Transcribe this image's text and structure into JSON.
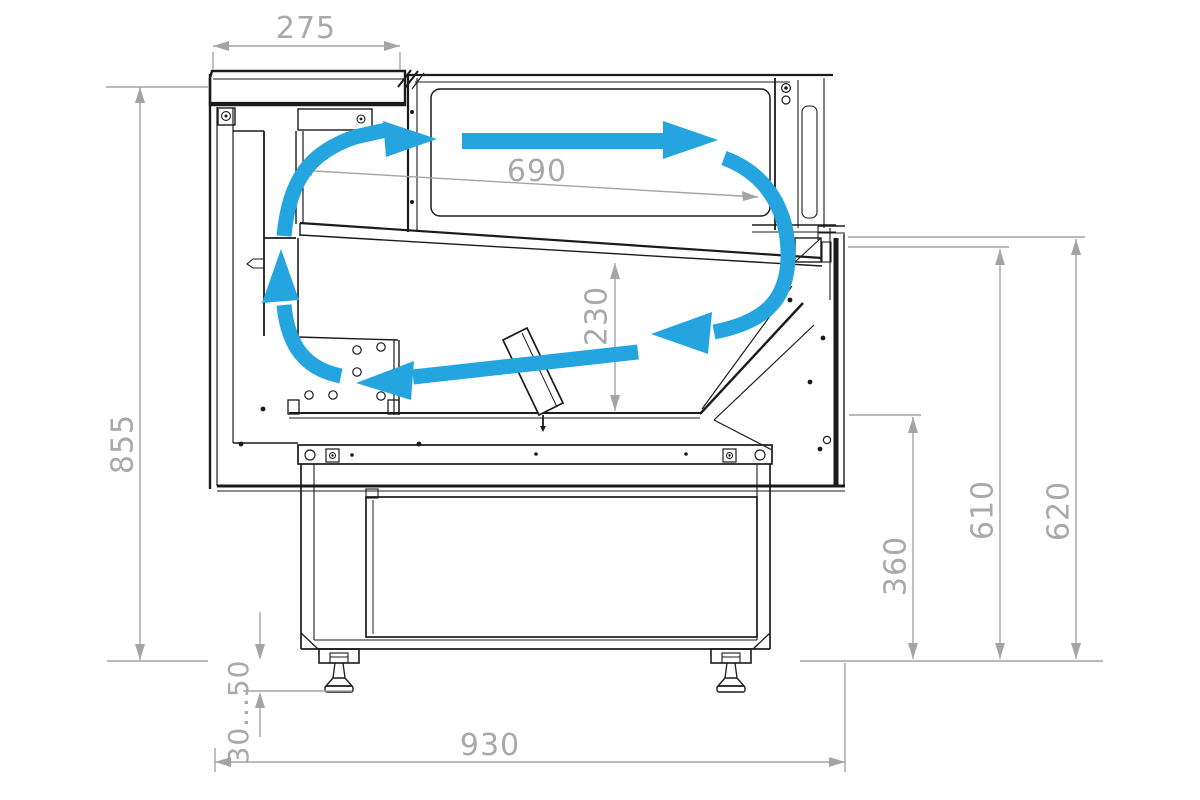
{
  "diagram": {
    "type": "technical cross-section drawing",
    "subject": "serve-over refrigerated display counter with airflow circulation",
    "colors": {
      "airflow": "#24a5df",
      "dimension_lines": "#a4a4a4",
      "dimension_text": "#a9a9a9",
      "outline": "#1b1b1b",
      "background": "#ffffff"
    },
    "dimensions": {
      "canopy_depth": "275",
      "display_deck_length": "690",
      "well_height": "230",
      "overall_height": "855",
      "lower_front_height": "360",
      "front_height_inner": "610",
      "front_height_outer": "620",
      "adjustable_feet_range": "30...50",
      "overall_depth": "930"
    }
  }
}
